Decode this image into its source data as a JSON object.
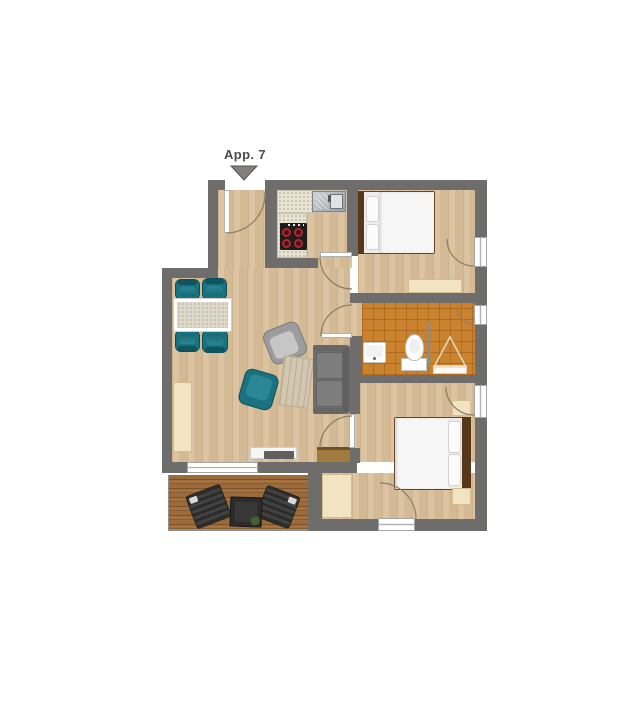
{
  "label": {
    "apartment": "App. 7"
  },
  "colors": {
    "wall": "#6e6d6b",
    "floor": "#d9c09b",
    "tile": "#c9832f",
    "counter": "#e9e3d4",
    "teal": "#19727f",
    "beige": "#f2e3c2",
    "bed-frame": "#6a4425",
    "arc": "#8d7f68",
    "label-text": "#4b4b4b",
    "marker": "#82817f",
    "deck-wood": "#9a6a3a",
    "lounger": "#303030"
  },
  "rooms": [
    "entrance-hall",
    "kitchen",
    "living-dining-room",
    "bedroom-1",
    "bathroom",
    "bedroom-2",
    "terrace"
  ],
  "elements": [
    "entrance-marker",
    "entrance-door",
    "kitchen-sink",
    "stove",
    "dining-table",
    "dining-chairs",
    "armchair-gray",
    "armchair-teal",
    "coffee-table",
    "sofa",
    "sideboard",
    "tv-lowboard",
    "wood-bench",
    "double-bed-1",
    "dresser",
    "bathroom-sink",
    "toilet",
    "shower",
    "double-bed-2",
    "nightstands",
    "wardrobe",
    "sun-loungers",
    "terrace-table"
  ]
}
